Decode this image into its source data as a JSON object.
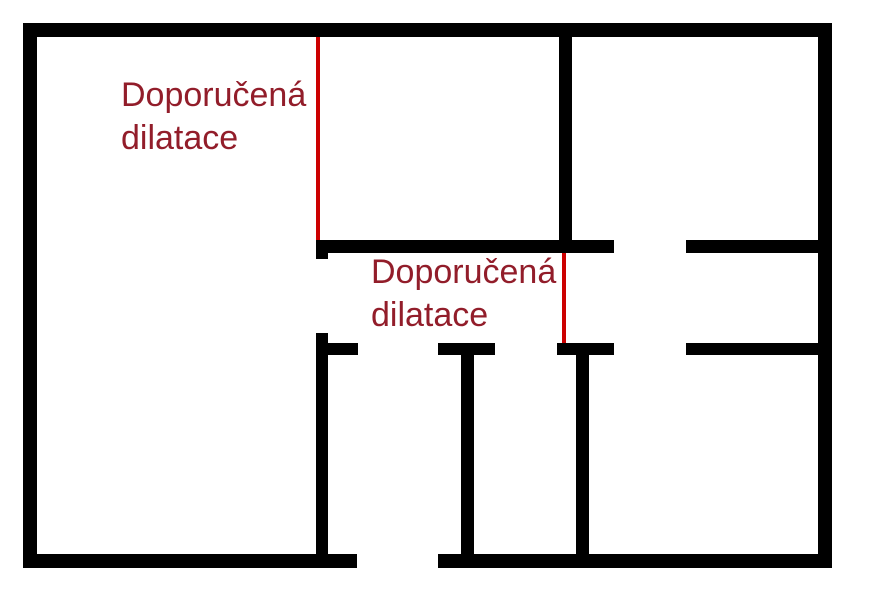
{
  "page": {
    "width": 877,
    "height": 600,
    "background": "#ffffff"
  },
  "colors": {
    "wall": "#000000",
    "dilatation": "#cc0000",
    "label": "#921d2a"
  },
  "labels": [
    {
      "line1": "Doporučená",
      "line2": "dilatace",
      "x": 121,
      "y": 74
    },
    {
      "line1": "Doporučená",
      "line2": "dilatace",
      "x": 371,
      "y": 251
    }
  ],
  "walls": [
    {
      "name": "outer-wall-top",
      "x": 23,
      "y": 23,
      "w": 809,
      "h": 14
    },
    {
      "name": "outer-wall-left",
      "x": 23,
      "y": 23,
      "w": 14,
      "h": 545
    },
    {
      "name": "outer-wall-right",
      "x": 818,
      "y": 23,
      "w": 14,
      "h": 545
    },
    {
      "name": "outer-wall-bottom-left",
      "x": 23,
      "y": 554,
      "w": 334,
      "h": 14
    },
    {
      "name": "outer-wall-bottom-right",
      "x": 438,
      "y": 554,
      "w": 394,
      "h": 14
    },
    {
      "name": "interior-wall-vertical-top",
      "x": 559,
      "y": 37,
      "w": 13,
      "h": 204
    },
    {
      "name": "interior-wall-middle-left",
      "x": 316,
      "y": 240,
      "w": 298,
      "h": 13
    },
    {
      "name": "interior-wall-middle-left-endcap",
      "x": 316,
      "y": 253,
      "w": 12,
      "h": 6
    },
    {
      "name": "interior-wall-middle-right",
      "x": 686,
      "y": 240,
      "w": 132,
      "h": 13
    },
    {
      "name": "interior-wall-vertical-left-lower",
      "x": 316,
      "y": 333,
      "w": 12,
      "h": 221
    },
    {
      "name": "interior-wall-arm-left",
      "x": 328,
      "y": 343,
      "w": 30,
      "h": 12
    },
    {
      "name": "interior-wall-t1-bar",
      "x": 438,
      "y": 343,
      "w": 57,
      "h": 12
    },
    {
      "name": "interior-wall-t1-stem",
      "x": 461,
      "y": 343,
      "w": 13,
      "h": 211
    },
    {
      "name": "interior-wall-t2-bar",
      "x": 557,
      "y": 343,
      "w": 57,
      "h": 12
    },
    {
      "name": "interior-wall-t2-stem",
      "x": 576,
      "y": 343,
      "w": 13,
      "h": 211
    },
    {
      "name": "interior-wall-lower-right",
      "x": 686,
      "y": 343,
      "w": 132,
      "h": 12
    }
  ],
  "dilatation_lines": [
    {
      "name": "dilatation-line-1",
      "x": 316,
      "y": 37,
      "w": 4,
      "h": 203
    },
    {
      "name": "dilatation-line-2",
      "x": 562,
      "y": 253,
      "w": 4,
      "h": 90
    }
  ]
}
